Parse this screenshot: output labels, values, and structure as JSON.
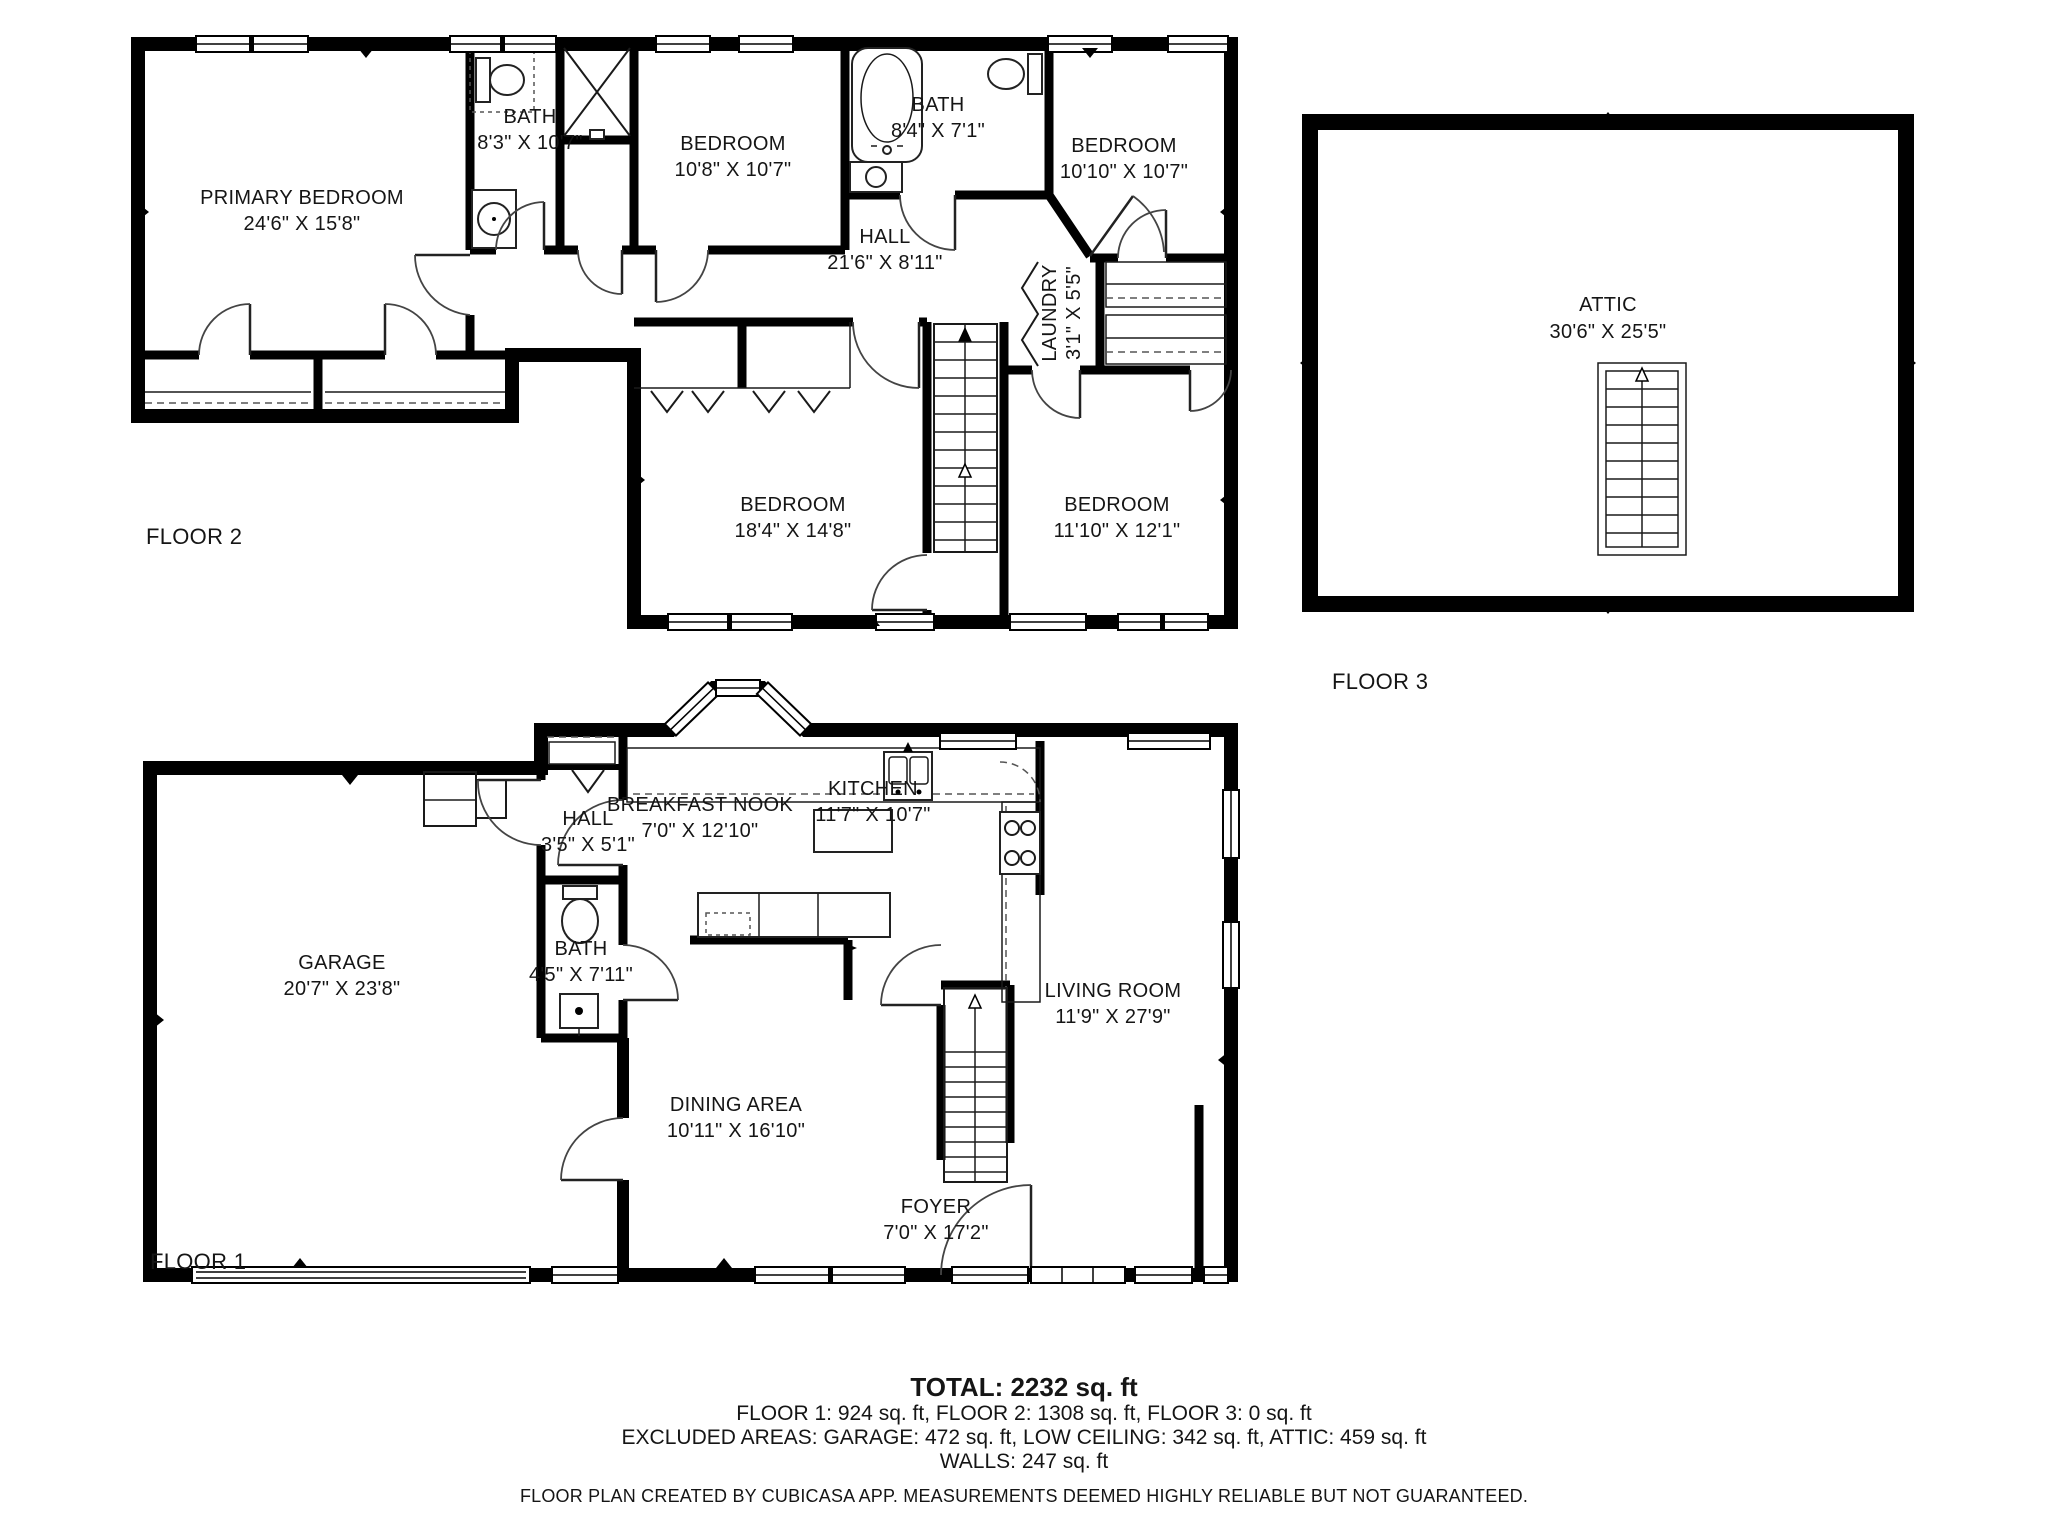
{
  "app": {
    "type": "floor-plan",
    "creator_note": "FLOOR PLAN CREATED BY CUBICASA APP. MEASUREMENTS DEEMED HIGHLY RELIABLE BUT NOT GUARANTEED."
  },
  "colors": {
    "wall": "#000000",
    "background": "#ffffff",
    "text": "#151515"
  },
  "floors": [
    {
      "label": "FLOOR 2",
      "rooms": [
        {
          "name": "PRIMARY BEDROOM",
          "dims": "24'6\" X 15'8\""
        },
        {
          "name": "BATH",
          "dims": "8'3\" X 10'7\""
        },
        {
          "name": "BEDROOM",
          "dims": "10'8\" X 10'7\""
        },
        {
          "name": "BATH",
          "dims": "8'4\" X 7'1\""
        },
        {
          "name": "BEDROOM",
          "dims": "10'10\" X 10'7\""
        },
        {
          "name": "HALL",
          "dims": "21'6\" X 8'11\""
        },
        {
          "name": "LAUNDRY",
          "dims": "3'1\" X 5'5\""
        },
        {
          "name": "BEDROOM",
          "dims": "18'4\" X 14'8\""
        },
        {
          "name": "BEDROOM",
          "dims": "11'10\" X 12'1\""
        }
      ]
    },
    {
      "label": "FLOOR 3",
      "rooms": [
        {
          "name": "ATTIC",
          "dims": "30'6\" X 25'5\""
        }
      ]
    },
    {
      "label": "FLOOR 1",
      "rooms": [
        {
          "name": "GARAGE",
          "dims": "20'7\" X 23'8\""
        },
        {
          "name": "HALL",
          "dims": "3'5\" X 5'1\""
        },
        {
          "name": "BREAKFAST NOOK",
          "dims": "7'0\" X 12'10\""
        },
        {
          "name": "KITCHEN",
          "dims": "11'7\" X 10'7\""
        },
        {
          "name": "BATH",
          "dims": "4'5\" X 7'11\""
        },
        {
          "name": "DINING AREA",
          "dims": "10'11\" X 16'10\""
        },
        {
          "name": "LIVING ROOM",
          "dims": "11'9\" X 27'9\""
        },
        {
          "name": "FOYER",
          "dims": "7'0\" X 17'2\""
        }
      ]
    }
  ],
  "summary": {
    "total": "TOTAL: 2232 sq. ft",
    "floors_line": "FLOOR 1: 924 sq. ft, FLOOR 2: 1308 sq. ft, FLOOR 3: 0 sq. ft",
    "excluded_line": "EXCLUDED AREAS: GARAGE: 472 sq. ft, LOW CEILING: 342 sq. ft, ATTIC: 459 sq. ft",
    "walls_line": "WALLS: 247 sq. ft",
    "disclaimer": "FLOOR PLAN CREATED BY CUBICASA APP. MEASUREMENTS DEEMED HIGHLY RELIABLE BUT NOT GUARANTEED."
  }
}
